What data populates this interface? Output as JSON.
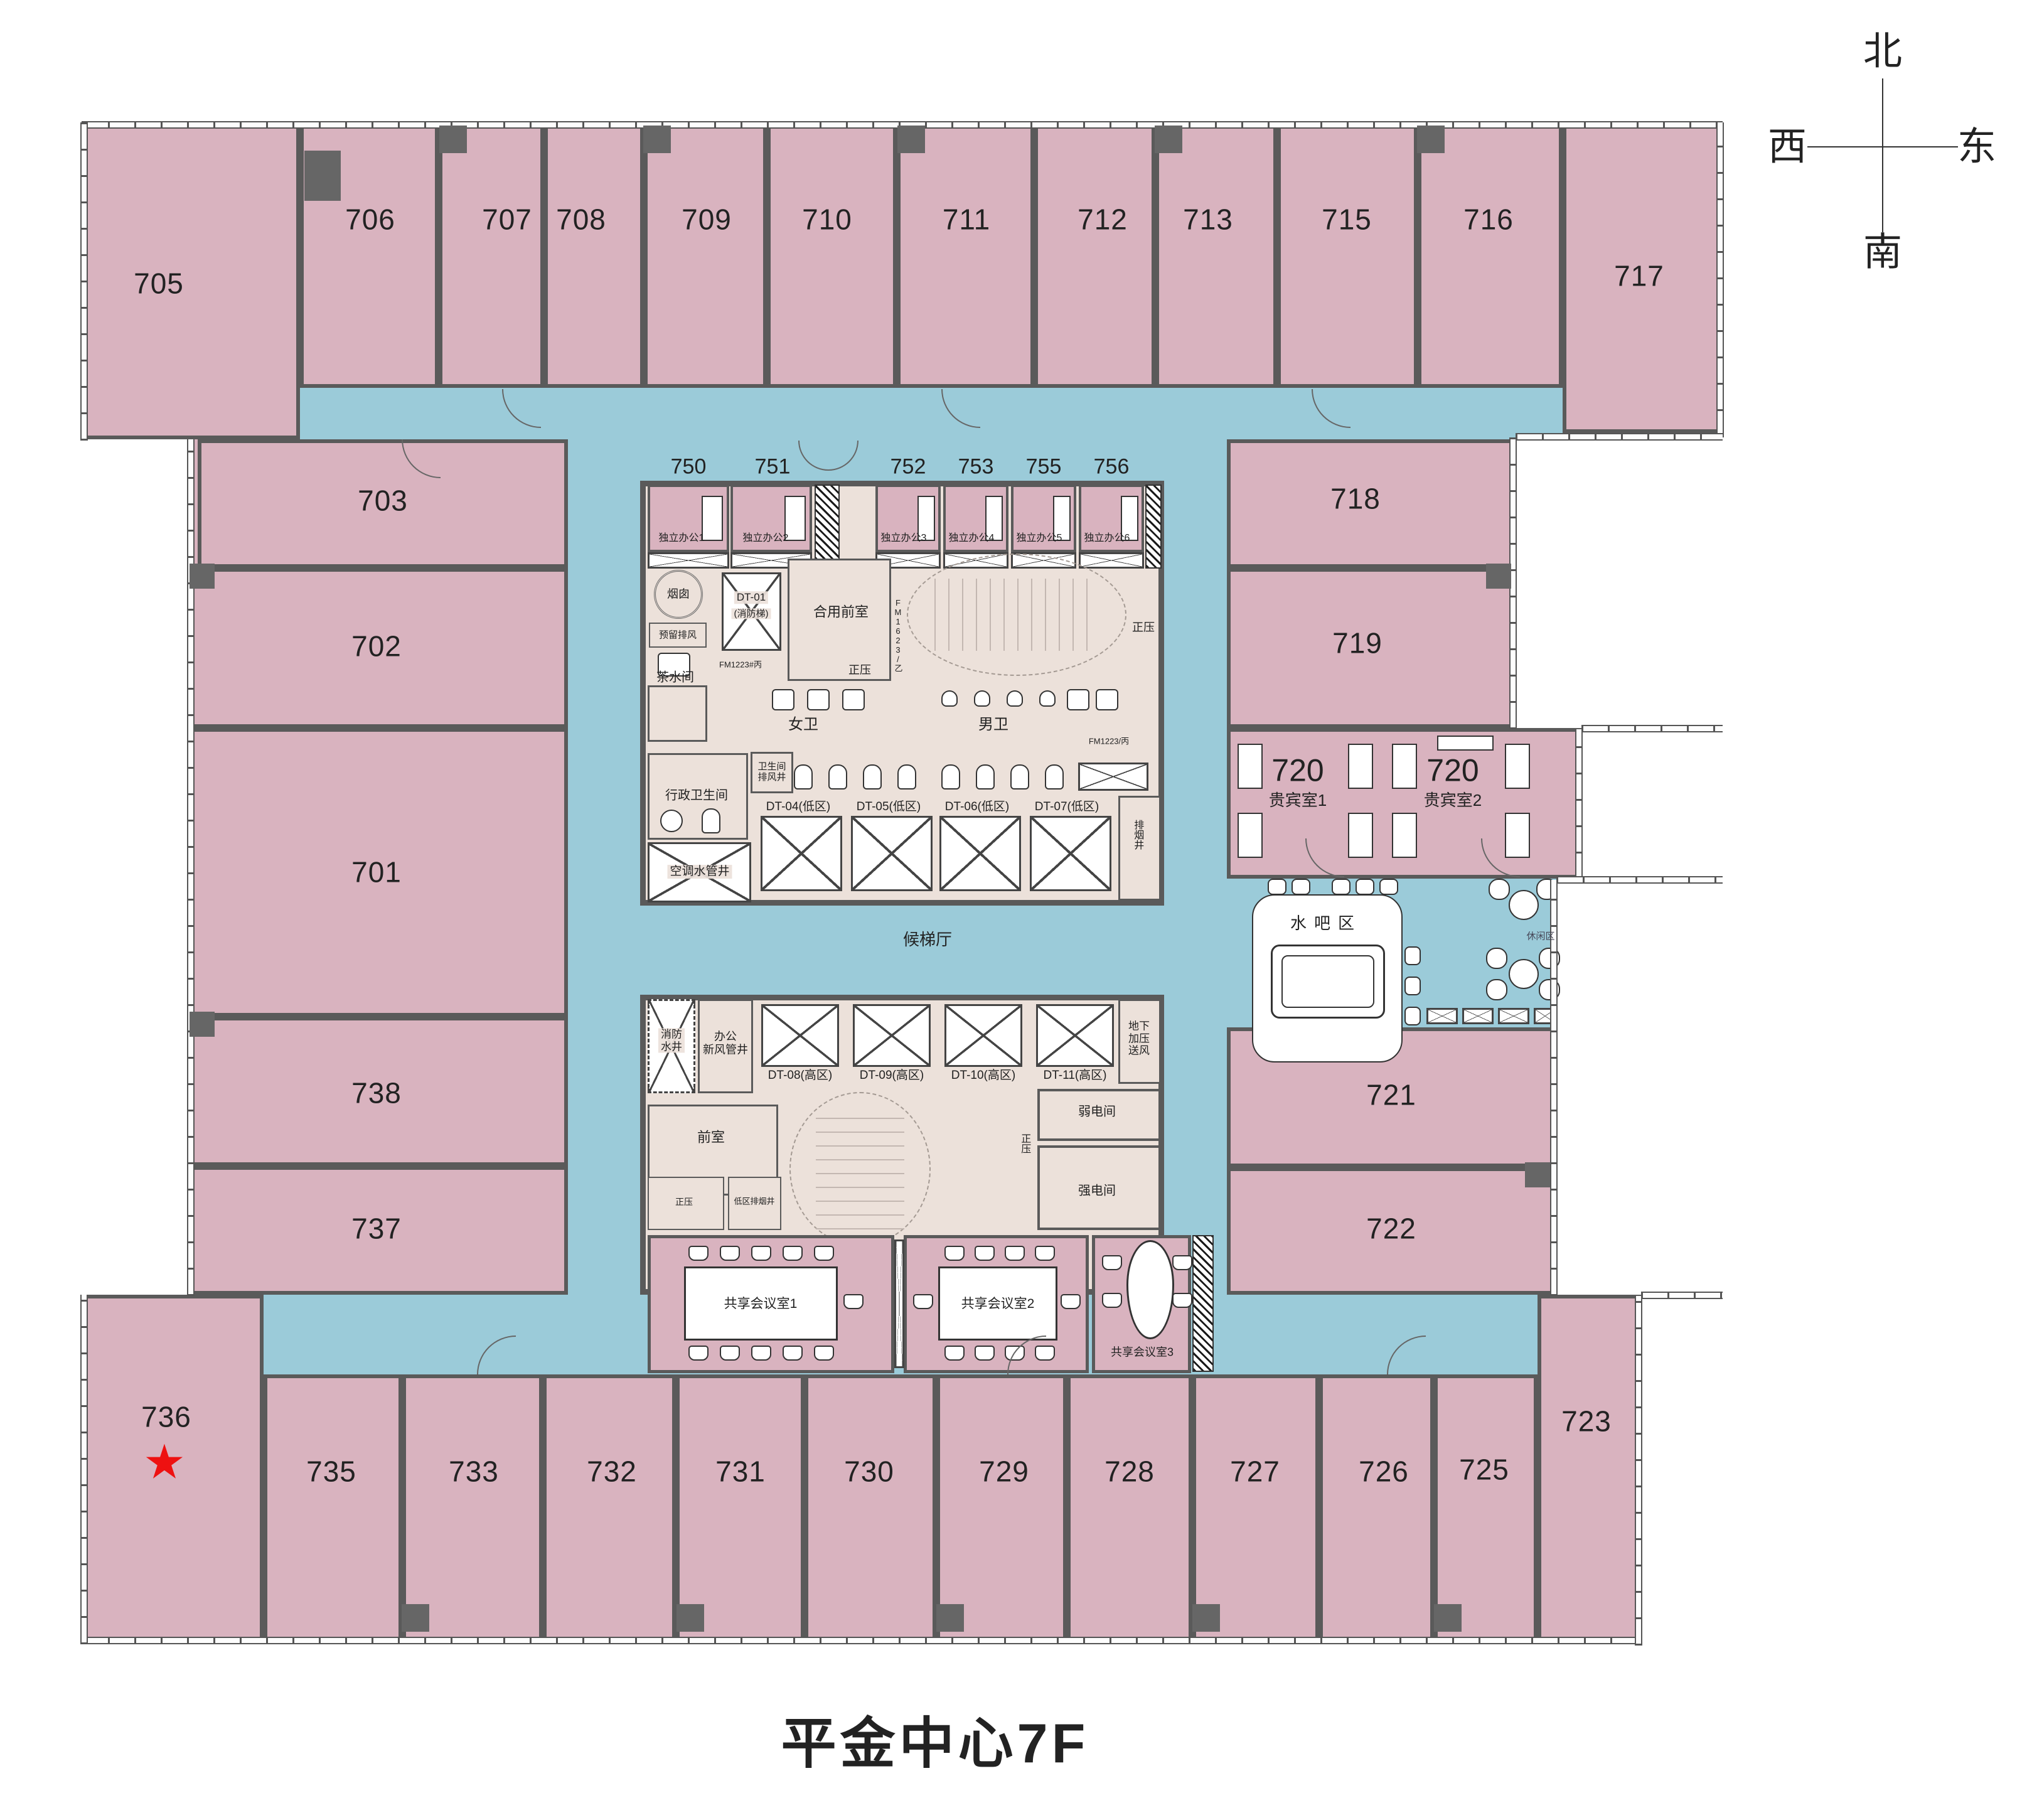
{
  "title": "平金中心7F",
  "compass": {
    "n": "北",
    "s": "南",
    "w": "西",
    "e": "东"
  },
  "colors": {
    "room_pink": "#d9b3bf",
    "corridor_blue": "#9bcbd9",
    "core_beige": "#ece1da",
    "wall_gray": "#5a5a5a",
    "star_red": "#ee1111"
  },
  "rooms": {
    "r701": "701",
    "r702": "702",
    "r703": "703",
    "r705": "705",
    "r706": "706",
    "r707": "707",
    "r708": "708",
    "r709": "709",
    "r710": "710",
    "r711": "711",
    "r712": "712",
    "r713": "713",
    "r715": "715",
    "r716": "716",
    "r717": "717",
    "r718": "718",
    "r719": "719",
    "r721": "721",
    "r722": "722",
    "r723": "723",
    "r725": "725",
    "r726": "726",
    "r727": "727",
    "r728": "728",
    "r729": "729",
    "r730": "730",
    "r731": "731",
    "r732": "732",
    "r733": "733",
    "r735": "735",
    "r736": "736",
    "r737": "737",
    "r738": "738"
  },
  "vip": {
    "number": "720",
    "room1": "贵宾室1",
    "room2": "贵宾室2"
  },
  "offices": {
    "o750": {
      "num": "750",
      "name": "独立办公1"
    },
    "o751": {
      "num": "751",
      "name": "独立办公2"
    },
    "o752": {
      "num": "752",
      "name": "独立办公3"
    },
    "o753": {
      "num": "753",
      "name": "独立办公4"
    },
    "o755": {
      "num": "755",
      "name": "独立办公5"
    },
    "o756": {
      "num": "756",
      "name": "独立办公6"
    }
  },
  "elevators": {
    "dt01a": "DT-01",
    "dt01b": "(消防梯)",
    "dt04": "DT-04(低区)",
    "dt05": "DT-05(低区)",
    "dt06": "DT-06(低区)",
    "dt07": "DT-07(低区)",
    "dt08": "DT-08(高区)",
    "dt09": "DT-09(高区)",
    "dt10": "DT-10(高区)",
    "dt11": "DT-11(高区)"
  },
  "core": {
    "chimney": "烟囱",
    "reserved_exhaust": "预留排风",
    "tea_room": "茶水间",
    "shared_front": "合用前室",
    "pos": "正压",
    "womens": "女卫",
    "mens": "男卫",
    "wc_shaft1": "卫生间",
    "wc_shaft2": "排风井",
    "exec_wc": "行政卫生间",
    "ac_shaft": "空调水管井",
    "smoke_shaft": "排烟井",
    "hall": "候梯厅",
    "fire1": "消防",
    "fire2": "水井",
    "fresh1": "办公",
    "fresh2": "新风管井",
    "ug1": "地下",
    "ug2": "加压",
    "ug3": "送风",
    "front": "前室",
    "low_smoke": "低区排烟井",
    "weak": "弱电间",
    "strong": "强电间",
    "fm1623": "FM1623/乙",
    "fm1223a": "FM1223#丙",
    "fm1223b": "FM1223/丙"
  },
  "amenities": {
    "water_bar": "水吧区",
    "lounge": "休闲区",
    "m1": "共享会议室1",
    "m2": "共享会议室2",
    "m3": "共享会议室3"
  },
  "legend": {
    "star": "★"
  }
}
